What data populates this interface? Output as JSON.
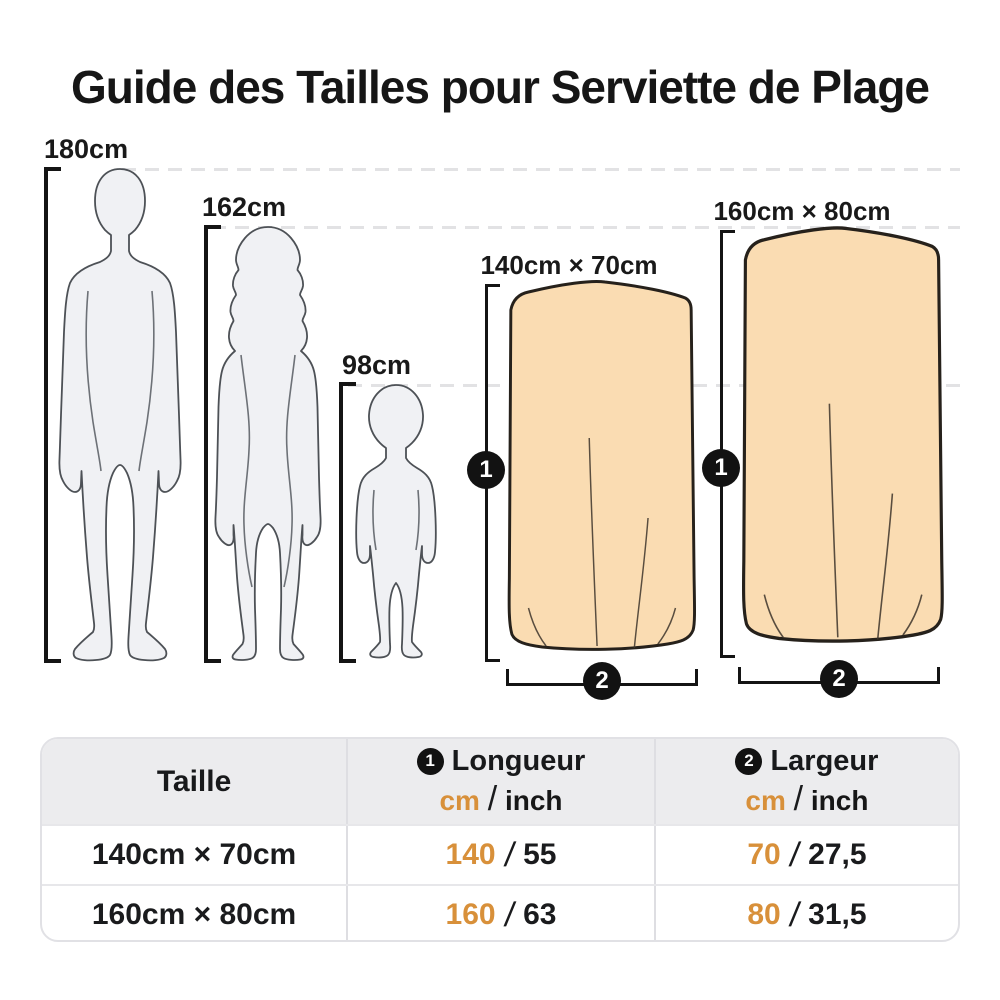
{
  "title": "Guide des Tailles pour Serviette de Plage",
  "figures": {
    "man": {
      "height_label": "180cm"
    },
    "woman": {
      "height_label": "162cm"
    },
    "child": {
      "height_label": "98cm"
    }
  },
  "towels": {
    "small": {
      "size_label": "140cm × 70cm",
      "length_badge": "1",
      "width_badge": "2"
    },
    "large": {
      "size_label": "160cm × 80cm",
      "length_badge": "1",
      "width_badge": "2"
    }
  },
  "table": {
    "header": {
      "taille": "Taille",
      "longueur": {
        "badge": "1",
        "label": "Longueur",
        "unit_cm": "cm",
        "unit_sep": "/",
        "unit_inch": "inch"
      },
      "largeur": {
        "badge": "2",
        "label": "Largeur",
        "unit_cm": "cm",
        "unit_sep": "/",
        "unit_inch": "inch"
      }
    },
    "rows": [
      {
        "taille": "140cm × 70cm",
        "longueur_cm": "140",
        "longueur_inch": "55",
        "largeur_cm": "70",
        "largeur_inch": "27,5",
        "sep": "/"
      },
      {
        "taille": "160cm × 80cm",
        "longueur_cm": "160",
        "longueur_inch": "63",
        "largeur_cm": "80",
        "largeur_inch": "31,5",
        "sep": "/"
      }
    ]
  },
  "colors": {
    "accent_orange": "#d8903a",
    "towel_fill": "#fadcb2",
    "badge_background": "#121212",
    "silhouette_fill": "#f0f1f4",
    "table_header_background": "#ececee",
    "dashed_line": "#e2e2e4"
  }
}
